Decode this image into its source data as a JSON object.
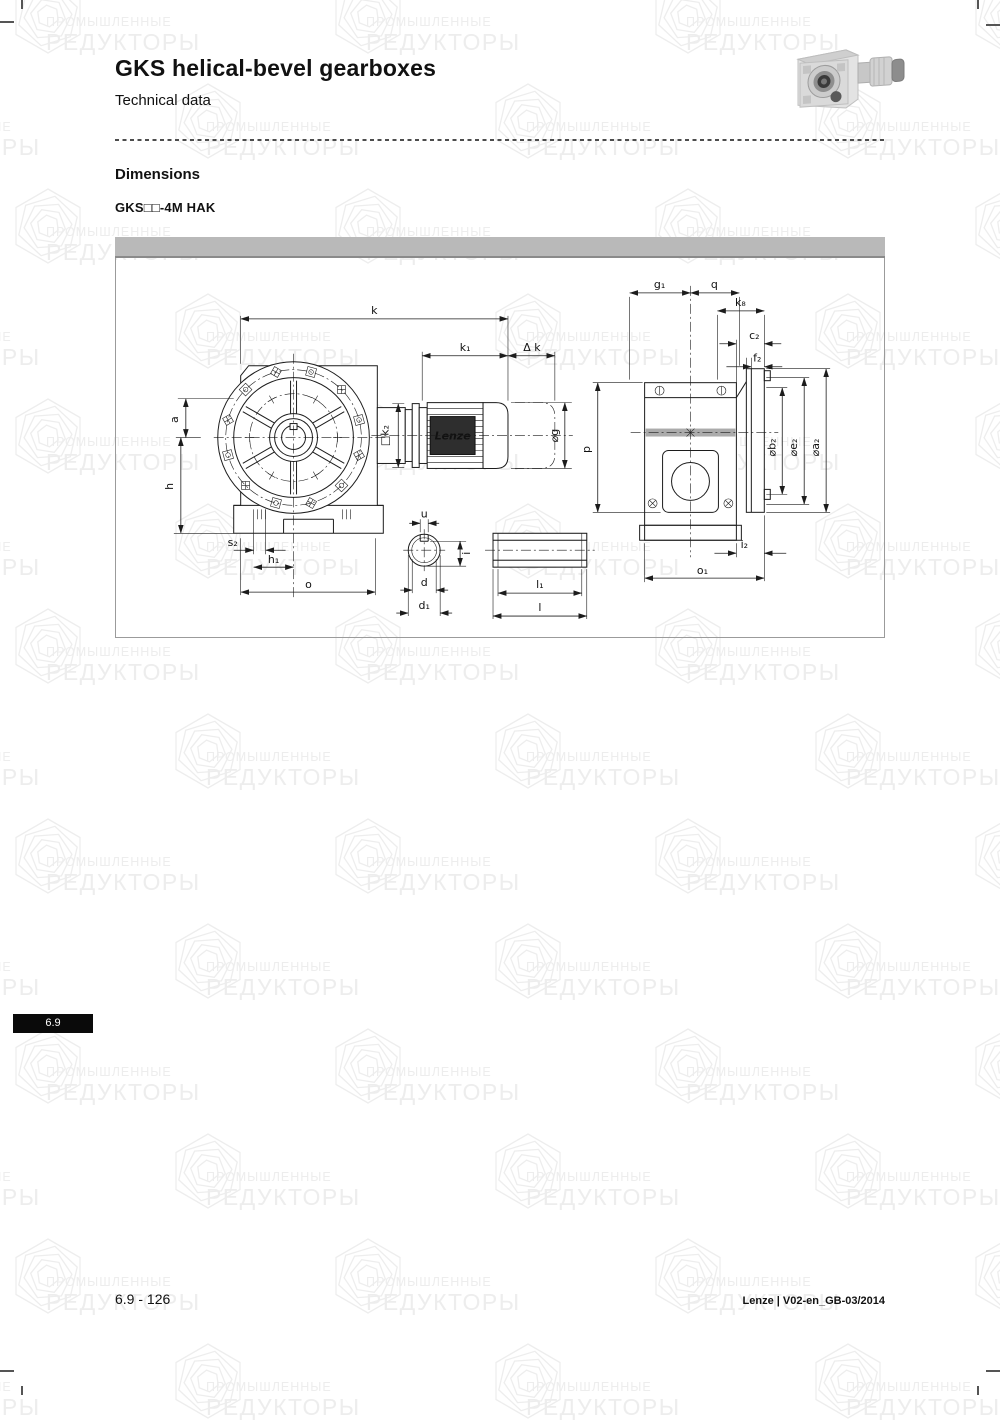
{
  "header": {
    "title": "GKS helical-bevel gearboxes",
    "subtitle": "Technical data"
  },
  "section": {
    "heading": "Dimensions",
    "model": "GKS□□-4M HAK"
  },
  "watermark": {
    "line1": "ПРОМЫШЛЕННЫЕ",
    "line2": "РЕДУКТОРЫ"
  },
  "tab": {
    "label": "6.9"
  },
  "footer": {
    "left": "6.9 - 126",
    "right": "Lenze | V02-en_GB-03/2014"
  },
  "diagram": {
    "nameplate": "Lenze",
    "labels": {
      "k": "k",
      "k1": "k₁",
      "dk": "Δ k",
      "a": "a",
      "h": "h",
      "s2": "s₂",
      "h1": "h₁",
      "o": "o",
      "k2": "□k₂",
      "g": "⌀g",
      "u": "u",
      "i": "i",
      "d": "d",
      "d1": "d₁",
      "l1": "l₁",
      "l": "l",
      "g1": "g₁",
      "q": "q",
      "k8": "k₈",
      "c2": "c₂",
      "f2": "f₂",
      "b2": "⌀b₂",
      "e2": "⌀e₂",
      "a2": "⌀a₂",
      "p": "p",
      "i2": "i₂",
      "o1": "o₁"
    }
  },
  "colors": {
    "panel_bar": "#b9b9b9",
    "tab_bg": "#0a0a0a",
    "line": "#1c1c1c",
    "watermark": "#ededed"
  }
}
